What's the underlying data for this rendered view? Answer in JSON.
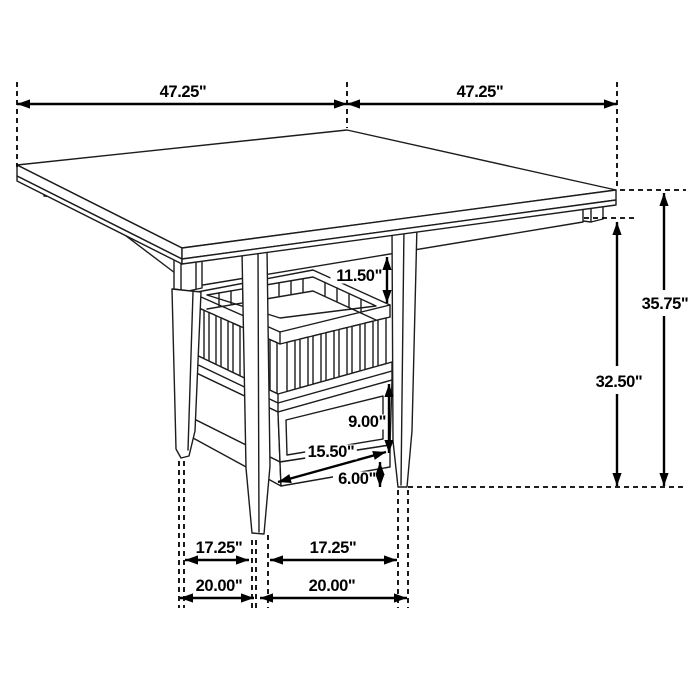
{
  "diagram": {
    "kind": "isometric-furniture-dimension-drawing",
    "subject": "counter-height square dining table with slatted storage pedestal and drawer",
    "units": "inches",
    "background_color": "#ffffff",
    "line_color": "#000000",
    "dimensions": [
      {
        "name": "tabletop-edge-left",
        "label": "47.25\"",
        "segments": [
          [
            17,
            104,
            347,
            104
          ]
        ],
        "arrows": [
          {
            "x": 17,
            "y": 104,
            "angle": 180
          },
          {
            "x": 347,
            "y": 104,
            "angle": 0
          }
        ],
        "label_x": 183,
        "label_y": 97,
        "anchor": "middle"
      },
      {
        "name": "tabletop-edge-right",
        "label": "47.25\"",
        "segments": [
          [
            347,
            104,
            617,
            104
          ]
        ],
        "arrows": [
          {
            "x": 347,
            "y": 104,
            "angle": 180
          },
          {
            "x": 617,
            "y": 104,
            "angle": 0
          }
        ],
        "label_x": 480,
        "label_y": 97,
        "anchor": "middle"
      },
      {
        "name": "overall-height",
        "label": "35.75\"",
        "segments": [
          [
            664,
            193,
            664,
            290
          ],
          [
            664,
            316,
            664,
            486
          ]
        ],
        "arrows": [
          {
            "x": 664,
            "y": 193,
            "angle": -90
          },
          {
            "x": 664,
            "y": 486,
            "angle": 90
          }
        ],
        "label_x": 665,
        "label_y": 309,
        "anchor": "middle"
      },
      {
        "name": "apron-to-floor-height",
        "label": "32.50\"",
        "segments": [
          [
            617,
            222,
            617,
            366
          ],
          [
            617,
            394,
            617,
            486
          ]
        ],
        "arrows": [
          {
            "x": 617,
            "y": 222,
            "angle": -90
          },
          {
            "x": 617,
            "y": 486,
            "angle": 90
          }
        ],
        "label_x": 619,
        "label_y": 387,
        "anchor": "middle"
      },
      {
        "name": "tabletop-to-basket-clearance",
        "label": "11.50\"",
        "segments": [
          [
            387,
            257,
            387,
            303
          ]
        ],
        "arrows": [
          {
            "x": 387,
            "y": 257,
            "angle": -90
          },
          {
            "x": 387,
            "y": 303,
            "angle": 90
          }
        ],
        "label_x": 382,
        "label_y": 281,
        "anchor": "end"
      },
      {
        "name": "drawer-section-height",
        "label": "9.00\"",
        "segments": [
          [
            389,
            384,
            389,
            453
          ]
        ],
        "arrows": [
          {
            "x": 389,
            "y": 384,
            "angle": -90
          },
          {
            "x": 389,
            "y": 453,
            "angle": 90
          }
        ],
        "label_x": 386,
        "label_y": 427,
        "anchor": "end"
      },
      {
        "name": "drawer-width",
        "label": "15.50\"",
        "segments": [
          [
            278,
            482,
            386,
            452
          ]
        ],
        "arrows": [
          {
            "x": 278,
            "y": 482,
            "angle": 164.5
          },
          {
            "x": 386,
            "y": 452,
            "angle": -15.5
          }
        ],
        "label_x": 331,
        "label_y": 457,
        "anchor": "middle"
      },
      {
        "name": "floor-clearance",
        "label": "6.00\"",
        "segments": [
          [
            380,
            462,
            380,
            487
          ]
        ],
        "arrows": [
          {
            "x": 380,
            "y": 462,
            "angle": -90
          },
          {
            "x": 380,
            "y": 487,
            "angle": 90
          }
        ],
        "label_x": 376,
        "label_y": 484,
        "anchor": "end"
      },
      {
        "name": "leg-spacing-inner-left",
        "label": "17.25\"",
        "segments": [
          [
            185,
            560,
            249,
            560
          ]
        ],
        "arrows": [
          {
            "x": 185,
            "y": 560,
            "angle": 180
          },
          {
            "x": 249,
            "y": 560,
            "angle": 0
          }
        ],
        "label_x": 219,
        "label_y": 553,
        "anchor": "middle"
      },
      {
        "name": "leg-spacing-inner-right",
        "label": "17.25\"",
        "segments": [
          [
            270,
            560,
            397,
            560
          ]
        ],
        "arrows": [
          {
            "x": 270,
            "y": 560,
            "angle": 180
          },
          {
            "x": 397,
            "y": 560,
            "angle": 0
          }
        ],
        "label_x": 333,
        "label_y": 553,
        "anchor": "middle"
      },
      {
        "name": "leg-spacing-outer-left",
        "label": "20.00\"",
        "segments": [
          [
            180,
            598,
            254,
            598
          ]
        ],
        "arrows": [
          {
            "x": 180,
            "y": 598,
            "angle": 180
          },
          {
            "x": 254,
            "y": 598,
            "angle": 0
          }
        ],
        "label_x": 219,
        "label_y": 591,
        "anchor": "middle"
      },
      {
        "name": "leg-spacing-outer-right",
        "label": "20.00\"",
        "segments": [
          [
            260,
            598,
            407,
            598
          ]
        ],
        "arrows": [
          {
            "x": 260,
            "y": 598,
            "angle": 180
          },
          {
            "x": 407,
            "y": 598,
            "angle": 0
          }
        ],
        "label_x": 332,
        "label_y": 591,
        "anchor": "middle"
      }
    ],
    "extension_lines": [
      {
        "name": "ext-tabletop-left-corner",
        "x1": 17,
        "y1": 82,
        "x2": 17,
        "y2": 167
      },
      {
        "name": "ext-tabletop-back-corner",
        "x1": 347,
        "y1": 82,
        "x2": 347,
        "y2": 128
      },
      {
        "name": "ext-tabletop-right-corner",
        "x1": 617,
        "y1": 82,
        "x2": 617,
        "y2": 186
      },
      {
        "name": "ext-tabletop-level",
        "x1": 620,
        "y1": 190,
        "x2": 686,
        "y2": 190
      },
      {
        "name": "ext-apron-level",
        "x1": 584,
        "y1": 218,
        "x2": 634,
        "y2": 218
      },
      {
        "name": "ext-floor-level",
        "x1": 408,
        "y1": 487,
        "x2": 686,
        "y2": 487
      },
      {
        "name": "ext-left-leg-outer",
        "x1": 179,
        "y1": 461,
        "x2": 179,
        "y2": 608
      },
      {
        "name": "ext-left-leg-inner",
        "x1": 184,
        "y1": 461,
        "x2": 184,
        "y2": 608
      },
      {
        "name": "ext-front-leg-left",
        "x1": 252,
        "y1": 540,
        "x2": 252,
        "y2": 608
      },
      {
        "name": "ext-front-leg-mid",
        "x1": 256,
        "y1": 540,
        "x2": 256,
        "y2": 608
      },
      {
        "name": "ext-front-leg-right",
        "x1": 268,
        "y1": 535,
        "x2": 268,
        "y2": 608
      },
      {
        "name": "ext-right-leg-inner",
        "x1": 398,
        "y1": 490,
        "x2": 398,
        "y2": 608
      },
      {
        "name": "ext-right-leg-outer",
        "x1": 408,
        "y1": 490,
        "x2": 408,
        "y2": 608
      }
    ]
  }
}
